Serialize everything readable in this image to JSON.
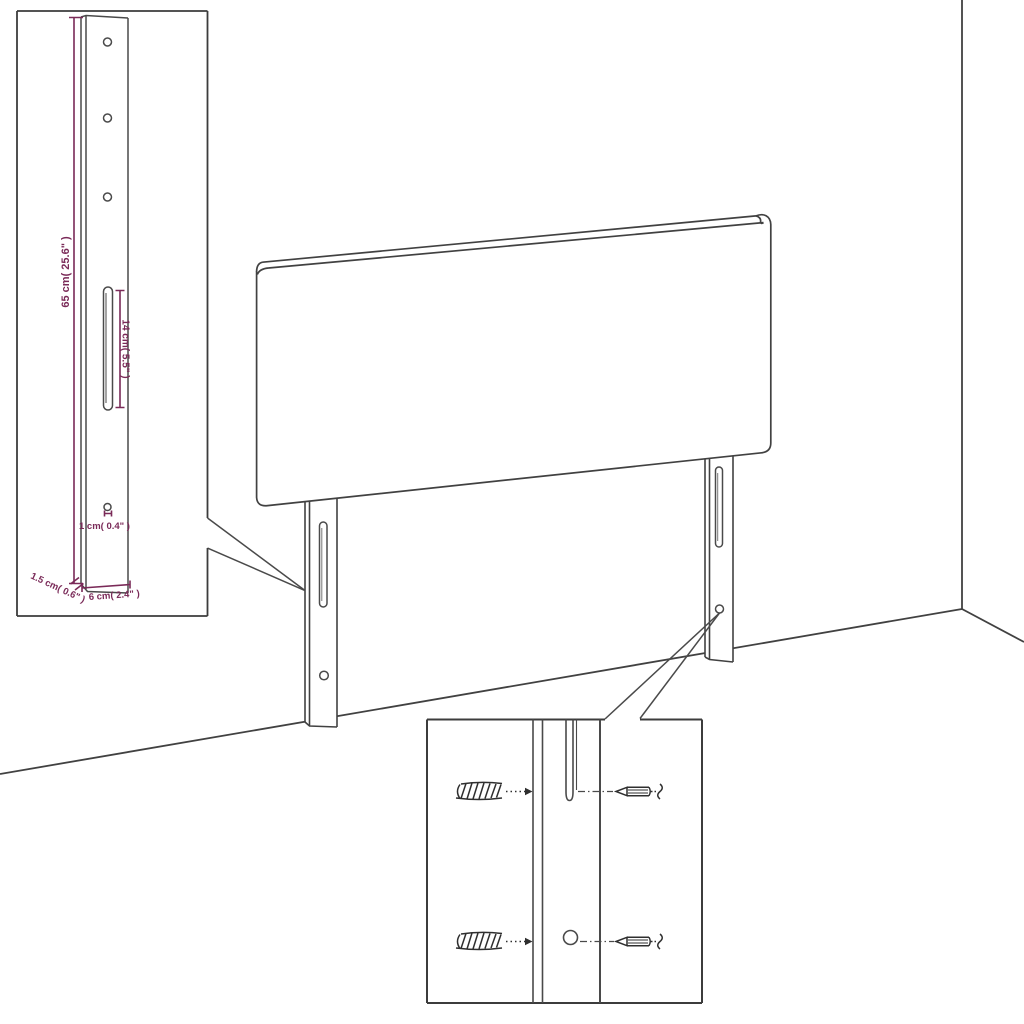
{
  "diagram": {
    "title": "Headboard with mounting legs — dimension diagram",
    "background_color": "#ffffff",
    "line_color": "#414141",
    "dimension_color": "#7a2a58",
    "main_drawing": {
      "description": "Upholstered headboard panel with two slotted mounting legs shown against a room corner",
      "leg_count": 2,
      "slots_per_leg": 1,
      "holes_per_leg": 1
    },
    "leg_detail_inset": {
      "description": "Enlarged mounting leg detail",
      "top_hole_count": 3,
      "dimensions": {
        "leg_height": "65 cm( 25.6\" )",
        "slot_length": "14 cm( 5.5\" )",
        "hole_diameter": "1 cm( 0.4\" )",
        "leg_thickness": "1.5 cm( 0.6\" )",
        "leg_width": "6 cm( 2.4\" )"
      }
    },
    "hardware_detail_inset": {
      "description": "Wall anchors and screws aligned with the leg slot and hole",
      "wall_anchor_count": 2,
      "screw_count": 2
    }
  }
}
